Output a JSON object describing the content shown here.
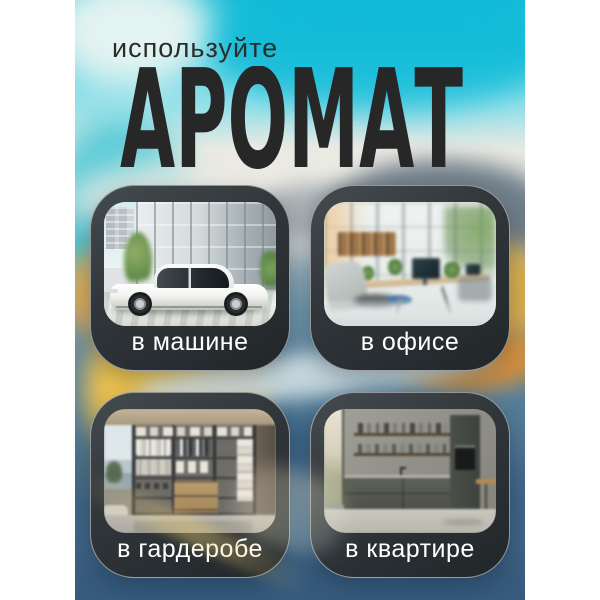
{
  "poster": {
    "kicker": "используйте",
    "title": "АРОМАТ",
    "title_color": "#272727",
    "kicker_color": "#2b2b2b",
    "frame_color": "#ffffff"
  },
  "cards": [
    {
      "label": "в машине",
      "photo": "white-sedan-near-glass-office-building"
    },
    {
      "label": "в офисе",
      "photo": "bright-open-plan-office-with-plants"
    },
    {
      "label": "в гардеробе",
      "photo": "walk-in-wardrobe-shelving-with-clothes"
    },
    {
      "label": "в квартире",
      "photo": "modern-grey-kitchen-with-open-shelves"
    }
  ],
  "style": {
    "card_background_top": "#454c50",
    "card_background_bottom": "#212629",
    "card_border": "rgba(255,255,255,0.5)",
    "label_color": "#ffffff",
    "sky_color": "#16bbd7",
    "water_color": "#3d6385",
    "foliage_yellow": "#ecc14f",
    "foliage_orange": "#dd8f35"
  }
}
